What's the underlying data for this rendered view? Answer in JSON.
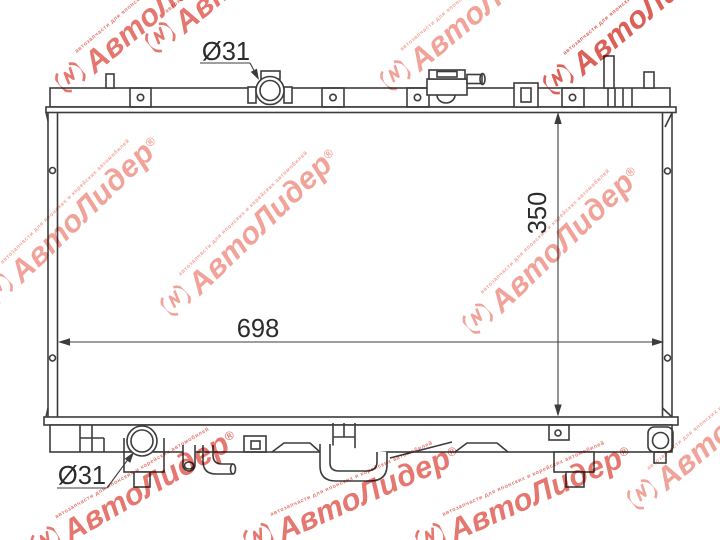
{
  "drawing": {
    "line_color": "#3c3c3c",
    "background": "#ffffff",
    "dimensions": {
      "core_width": "698",
      "core_height": "350",
      "filler_neck_diameter": "Ø31",
      "outlet_diameter": "Ø31"
    }
  },
  "watermark": {
    "brand": "АвтоЛидер",
    "registered_mark": "®",
    "small_text": "автозапчасти для японских и корейских автомобилей",
    "colors": {
      "strong_red": "#d84f46",
      "mid_red": "#e2685f",
      "light_red": "#f0998f"
    }
  }
}
